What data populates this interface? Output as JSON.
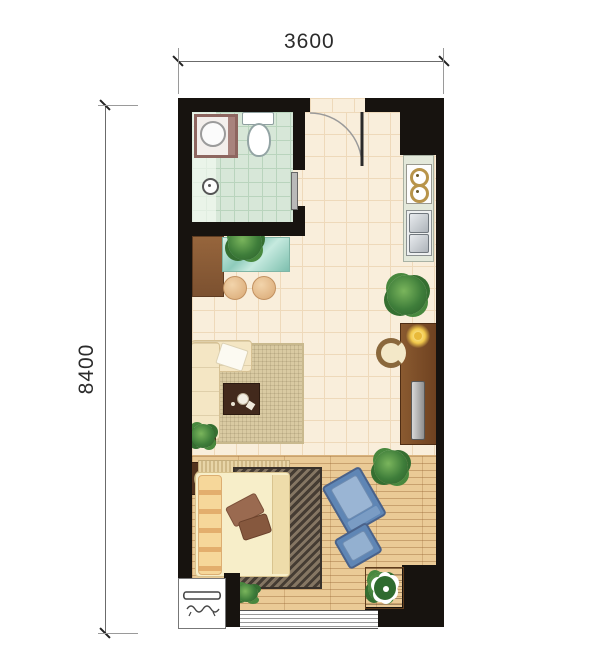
{
  "dimensions": {
    "top": "3600",
    "left": "8400"
  },
  "palette": {
    "wall": "#17130f",
    "tile_floor": "#f9eedb",
    "tile_grid": "#eed9ba",
    "bath_floor": "#d7e7d8",
    "bath_grid": "#b9d4bd",
    "wood_floor": "#eaca96",
    "counter": "#e3e8da",
    "rug": "#d9caa2",
    "coffee_table": "#42291c",
    "bed": "#f7eec9",
    "chair_blue": "#5f86b5",
    "lamp": "#f2c94c",
    "plant_green": "#3e7d3a",
    "bar_teal": "#8ecbbb"
  },
  "furniture": [
    "washing-machine",
    "toilet",
    "floor-drain",
    "sliding-door",
    "entry-door",
    "stove",
    "kitchen-sink",
    "kitchen-counter",
    "bar-cabinet",
    "bar-table",
    "bar-stools",
    "sofa",
    "area-rug",
    "coffee-table",
    "console-desk",
    "desk-lamp",
    "tv",
    "ring-chair",
    "bed",
    "nightstand",
    "bedside-lamp",
    "bed-rug",
    "lounge-chair",
    "ottoman",
    "flower-planter",
    "potted-plants",
    "window",
    "ac-outdoor-unit"
  ]
}
